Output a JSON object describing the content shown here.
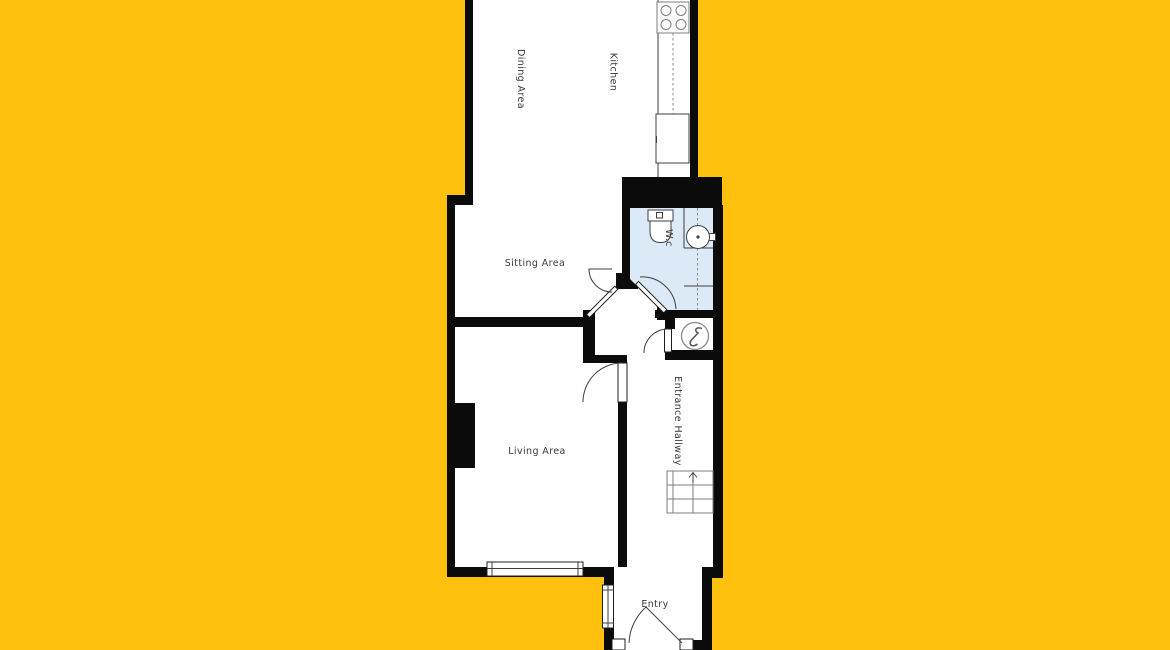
{
  "document": {
    "type": "residential-floor-plan",
    "floor_shown": "ground-floor-partial"
  },
  "palette": {
    "background": "#FFC10D",
    "walls": "#0B0B0B",
    "room_fill": "#FFFFFF",
    "wc_fill": "#DCE9F6",
    "line": "#3F3F3F",
    "text": "#3A3A3A"
  },
  "rooms": {
    "dining": {
      "label": "Dining Area"
    },
    "kitchen": {
      "label": "Kitchen"
    },
    "sitting": {
      "label": "Sitting Area"
    },
    "wc": {
      "label": "W.c"
    },
    "living": {
      "label": "Living Area"
    },
    "hallway": {
      "label": "Entrance Hallway"
    },
    "entry": {
      "label": "Entry"
    }
  },
  "fixtures": {
    "kitchen": [
      "stove-hob-icon",
      "counter-run",
      "appliance-unit"
    ],
    "wc": [
      "toilet-icon",
      "sink-icon",
      "vanity-lines"
    ],
    "hallway": [
      "staircase-icon",
      "electric-meter-icon",
      "meter-cupboard"
    ],
    "windows": [
      "living-area-window",
      "entry-side-window"
    ],
    "doors": [
      "living-door",
      "sitting-diagonal-door",
      "wc-diagonal-door",
      "cupboard-door",
      "entry-front-door"
    ],
    "stairs_direction": "up"
  }
}
